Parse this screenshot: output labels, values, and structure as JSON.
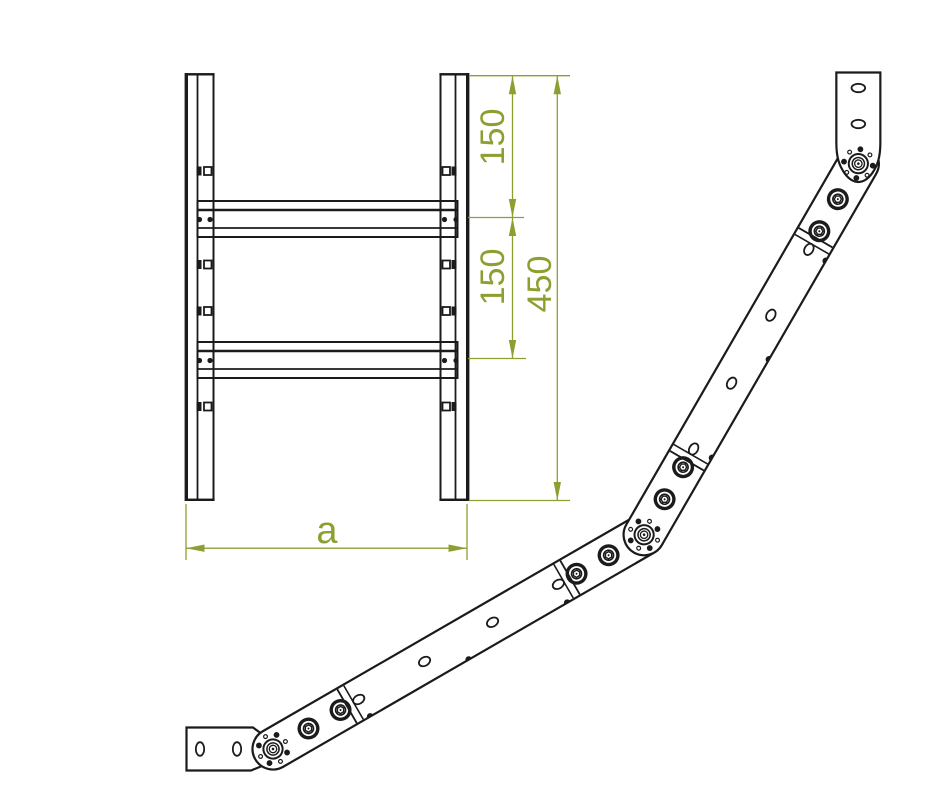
{
  "dimensions": {
    "top_to_first_rung": "150",
    "rung_to_rung": "150",
    "total_height": "450",
    "width_label": "a"
  },
  "colors": {
    "dimension_green": "#8ca032",
    "drawing_line": "#1b1b1b",
    "background": "#ffffff"
  }
}
